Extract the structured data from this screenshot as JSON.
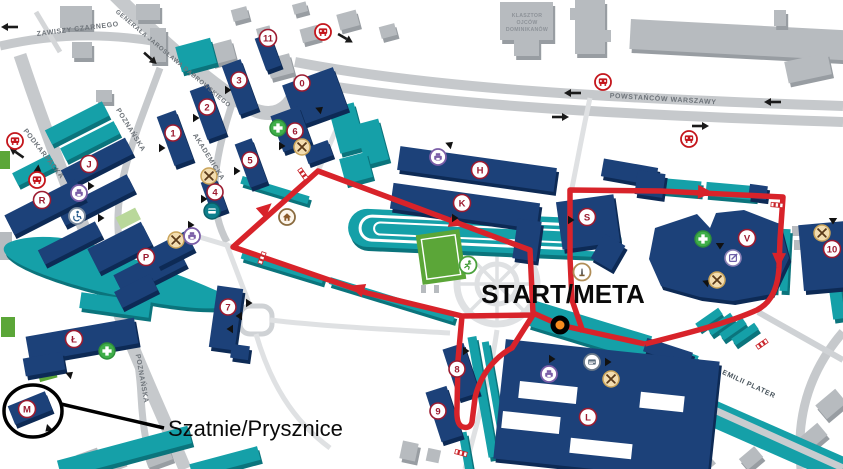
{
  "map": {
    "start_finish_label": "START/META",
    "lockers_label": "Szatnie/Prysznice"
  },
  "streets": {
    "zawiszy_czarnego": "ZAWISZY CZARNEGO",
    "gen_jaroslawa_dabrowskiego": "GENERAŁA JAROSŁAWA DĄBROWSKIEGO",
    "podkarpacka": "PODKARPACKA",
    "poznanska": "POZNAŃSKA",
    "akademicka": "AKADEMICKA",
    "powstancow_warszawy": "POWSTAŃCÓW WARSZAWY",
    "emilii_plater": "EMILII PLATER"
  },
  "landmarks": {
    "monastery_line1": "KLASZTOR",
    "monastery_line2": "OJCÓW",
    "monastery_line3": "DOMINIKANÓW"
  },
  "buildings": {
    "numbered": [
      "0",
      "1",
      "2",
      "3",
      "4",
      "5",
      "6",
      "7",
      "8",
      "9",
      "10",
      "11"
    ],
    "lettered": [
      "H",
      "K",
      "S",
      "V",
      "L",
      "J",
      "R",
      "P",
      "Ł",
      "M"
    ]
  },
  "icons": {
    "bus_stop": "bus-stop",
    "food_point": "food-court",
    "first_aid": "first-aid-cross",
    "print_point": "print-copy",
    "accessible_entrance": "wheelchair-access",
    "atm": "atm-card",
    "house": "home-info",
    "monument": "monument-obelisk",
    "sports": "sports-field",
    "edit_point": "registration-desk"
  },
  "route": {
    "color": "#d8232a",
    "start_marker_color": "#f68b1f"
  },
  "colors": {
    "campus_building": "#1c4179",
    "secondary_building": "#15a0a8",
    "public_building": "#b7bbbf",
    "road": "#c6c9cc",
    "field_green": "#5ba638",
    "badge": "#9c1b30"
  }
}
